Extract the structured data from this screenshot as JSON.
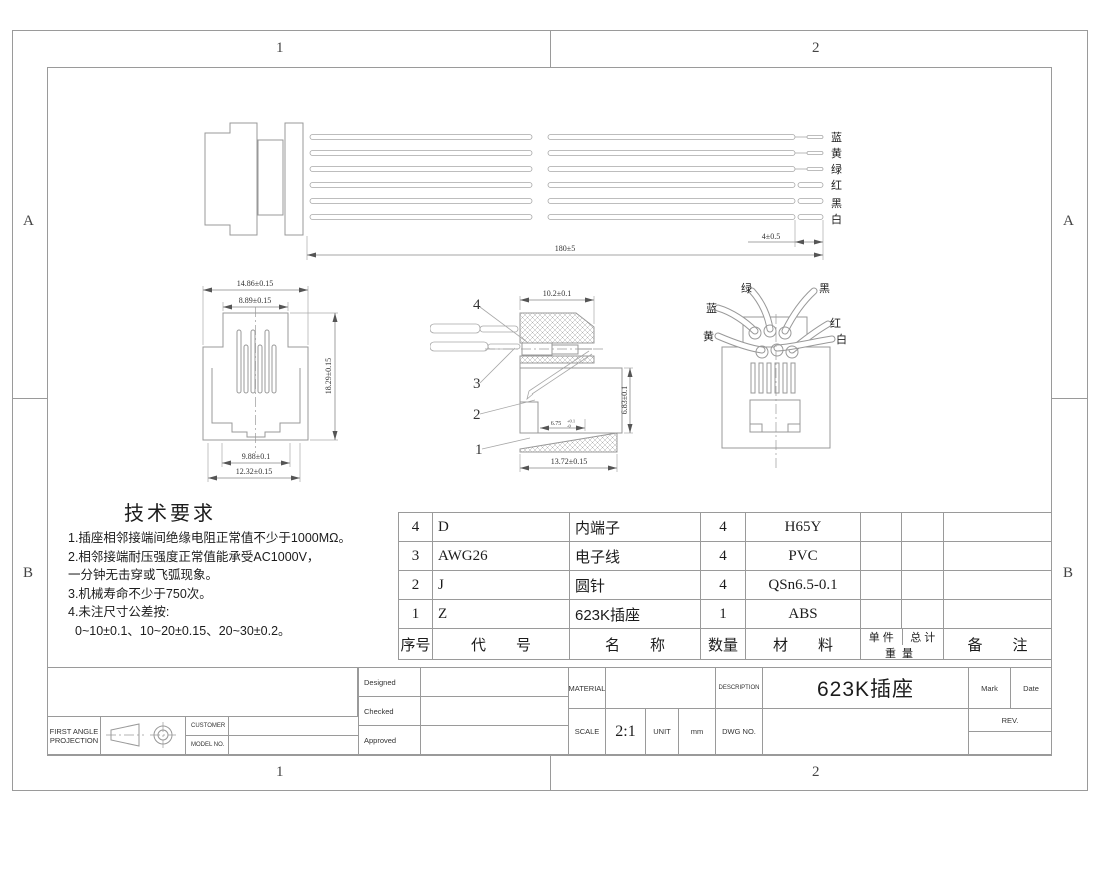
{
  "sheet": {
    "zone_top_1": "1",
    "zone_top_2": "2",
    "zone_bottom_1": "1",
    "zone_bottom_2": "2",
    "zone_left_a": "A",
    "zone_left_b": "B",
    "zone_right_a": "A",
    "zone_right_b": "B"
  },
  "cable_view": {
    "dim_length": "180±5",
    "dim_strip": "4±0.5",
    "wire_labels": [
      "蓝",
      "黄",
      "绿",
      "红",
      "黑",
      "白"
    ]
  },
  "front_view": {
    "dim_top_outer": "14.86±0.15",
    "dim_top_inner": "8.89±0.15",
    "dim_height": "18.29±0.15",
    "dim_bottom_inner": "9.88±0.1",
    "dim_bottom_outer": "12.32±0.15"
  },
  "section_view": {
    "callout_4": "4",
    "callout_3": "3",
    "callout_2": "2",
    "callout_1": "1",
    "dim_width_top": "10.2±0.1",
    "dim_height": "6.83±0.1",
    "dim_inner": "6.75",
    "dim_inner_tol_plus": "+0.1",
    "dim_inner_tol_minus": "-0",
    "dim_width_bottom": "13.72±0.15"
  },
  "back_view": {
    "label_green": "绿",
    "label_black": "黑",
    "label_blue": "蓝",
    "label_red": "红",
    "label_yellow": "黄",
    "label_white": "白"
  },
  "tech_requirements": {
    "title": "技术要求",
    "items": [
      "1.插座相邻接端间绝缘电阻正常值不少于1000MΩ。",
      "2.相邻接端耐压强度正常值能承受AC1000V，",
      "一分钟无击穿或飞弧现象。",
      "3.机械寿命不少于750次。",
      "4.未注尺寸公差按:",
      "0~10±0.1、10~20±0.15、20~30±0.2。"
    ]
  },
  "bom": {
    "rows": [
      {
        "no": "4",
        "code": "D",
        "name": "内端子",
        "qty": "4",
        "material": "H65Y"
      },
      {
        "no": "3",
        "code": "AWG26",
        "name": "电子线",
        "qty": "4",
        "material": "PVC"
      },
      {
        "no": "2",
        "code": "J",
        "name": "圆针",
        "qty": "4",
        "material": "QSn6.5-0.1"
      },
      {
        "no": "1",
        "code": "Z",
        "name": "623K插座",
        "qty": "1",
        "material": "ABS"
      }
    ],
    "headers": {
      "no": "序号",
      "code": "代　　号",
      "name": "名　　称",
      "qty": "数量",
      "material": "材　　料",
      "unit_weight": "单 件",
      "total_weight": "总 计",
      "weight": "重量",
      "remark": "备　　注"
    }
  },
  "title_block": {
    "designed": "Designed",
    "checked": "Checked",
    "approved": "Approved",
    "material_label": "MATERIAL",
    "scale_label": "SCALE",
    "scale_value": "2:1",
    "unit_label": "UNIT",
    "unit_value": "mm",
    "dwg_no_label": "DWG NO.",
    "description_label": "DESCRIPTION",
    "description_value": "623K插座",
    "mark": "Mark",
    "date": "Date",
    "rev": "REV.",
    "projection_line1": "FIRST ANGLE",
    "projection_line2": "PROJECTION",
    "customer": "CUSTOMER",
    "model_no": "MODEL NO."
  }
}
